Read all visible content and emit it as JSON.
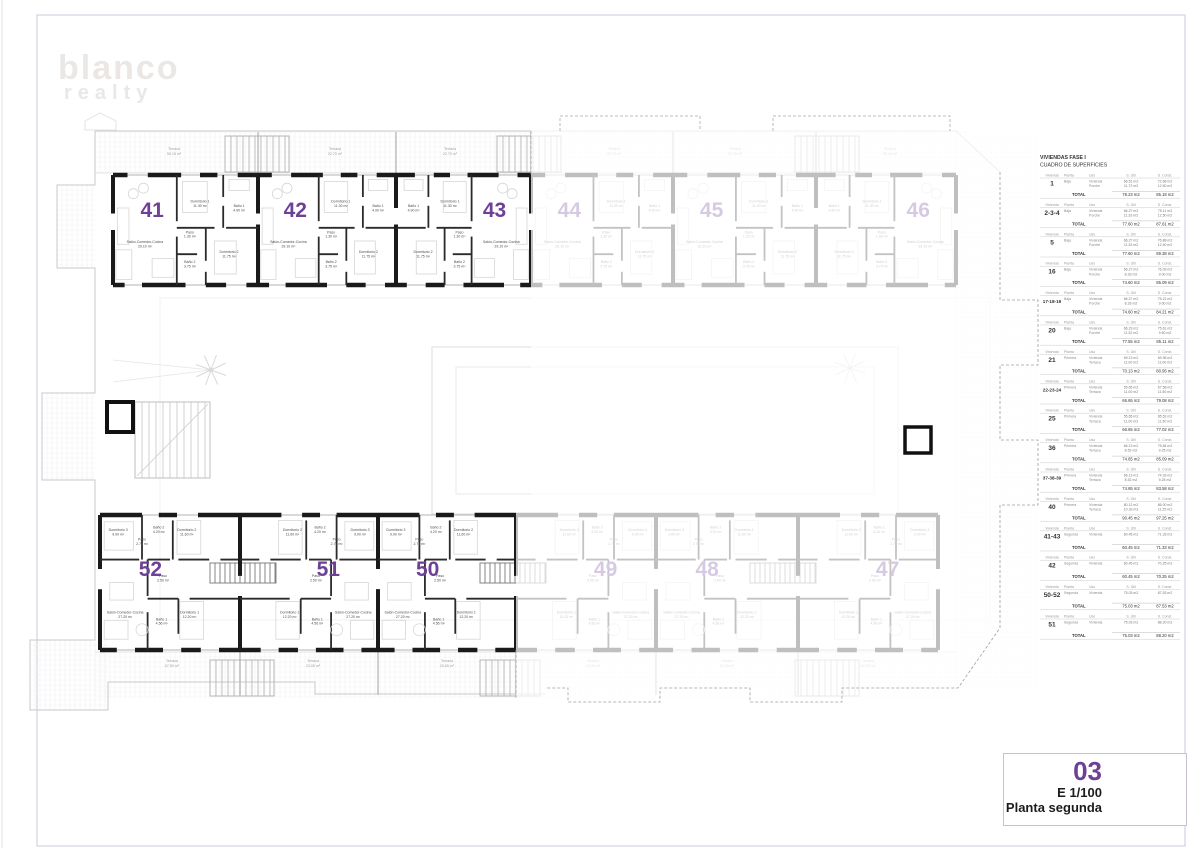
{
  "sheet": {
    "watermark_line1": "blanco",
    "watermark_line2": "realty",
    "number": "03",
    "scale": "E 1/100",
    "floor_name": "Planta segunda",
    "accent_color": "#6e4096"
  },
  "surfaces_table": {
    "title1": "VIVIENDAS FASE I",
    "title2": "CUADRO DE SUPERFICIES",
    "headers": [
      "Vivienda",
      "Planta",
      "Uso",
      "S. Útil",
      "S. Const."
    ],
    "total_label": "TOTAL",
    "blocks": [
      {
        "vivienda": "1",
        "planta": "Baja",
        "usos": [
          {
            "uso": "Vivienda",
            "util": "66.51 m2",
            "const": "72.68 m2"
          },
          {
            "uso": "Porche",
            "util": "11.72 m2",
            "const": "12.50 m2"
          }
        ],
        "total_util": "78.23 m2",
        "total_const": "85.18 m2"
      },
      {
        "vivienda": "2-3-4",
        "planta": "Baja",
        "usos": [
          {
            "uso": "Vivienda",
            "util": "66.27 m2",
            "const": "75.11 m2"
          },
          {
            "uso": "Porche",
            "util": "11.33 m2",
            "const": "12.50 m2"
          }
        ],
        "total_util": "77.60 m2",
        "total_const": "87.61 m2"
      },
      {
        "vivienda": "5",
        "planta": "Baja",
        "usos": [
          {
            "uso": "Vivienda",
            "util": "66.27 m2",
            "const": "76.88 m2"
          },
          {
            "uso": "Porche",
            "util": "11.33 m2",
            "const": "12.50 m2"
          }
        ],
        "total_util": "77.60 m2",
        "total_const": "89.38 m2"
      },
      {
        "vivienda": "16",
        "planta": "Baja",
        "usos": [
          {
            "uso": "Vivienda",
            "util": "66.27 m2",
            "const": "76.09 m2"
          },
          {
            "uso": "Porche",
            "util": "8.33 m2",
            "const": "9.00 m2"
          }
        ],
        "total_util": "74.60 m2",
        "total_const": "85.09 m2"
      },
      {
        "vivienda": "17-18-19",
        "planta": "Baja",
        "usos": [
          {
            "uso": "Vivienda",
            "util": "66.27 m2",
            "const": "75.21 m2"
          },
          {
            "uso": "Porche",
            "util": "8.33 m2",
            "const": "9.00 m2"
          }
        ],
        "total_util": "74.60 m2",
        "total_const": "84.21 m2"
      },
      {
        "vivienda": "20",
        "planta": "Baja",
        "usos": [
          {
            "uso": "Vivienda",
            "util": "66.23 m2",
            "const": "75.61 m2"
          },
          {
            "uso": "Porche",
            "util": "11.32 m2",
            "const": "9.50 m2"
          }
        ],
        "total_util": "77.55 m2",
        "total_const": "85.11 m2"
      },
      {
        "vivienda": "21",
        "planta": "Primera",
        "usos": [
          {
            "uso": "Vivienda",
            "util": "59.13 m2",
            "const": "69.95 m2"
          },
          {
            "uso": "Terraza",
            "util": "11.00 m2",
            "const": "11.00 m2"
          }
        ],
        "total_util": "70.13 m2",
        "total_const": "80.95 m2"
      },
      {
        "vivienda": "22-23-24",
        "planta": "Primera",
        "usos": [
          {
            "uso": "Vivienda",
            "util": "55.65 m2",
            "const": "67.58 m2"
          },
          {
            "uso": "Terraza",
            "util": "11.00 m2",
            "const": "11.50 m2"
          }
        ],
        "total_util": "66.65 m2",
        "total_const": "79.08 m2"
      },
      {
        "vivienda": "25",
        "planta": "Primera",
        "usos": [
          {
            "uso": "Vivienda",
            "util": "55.65 m2",
            "const": "65.52 m2"
          },
          {
            "uso": "Terraza",
            "util": "11.00 m2",
            "const": "11.50 m2"
          }
        ],
        "total_util": "66.65 m2",
        "total_const": "77.02 m2"
      },
      {
        "vivienda": "36",
        "planta": "Primera",
        "usos": [
          {
            "uso": "Vivienda",
            "util": "66.13 m2",
            "const": "75.84 m2"
          },
          {
            "uso": "Terraza",
            "util": "8.52 m2",
            "const": "9.25 m2"
          }
        ],
        "total_util": "74.65 m2",
        "total_const": "85.09 m2"
      },
      {
        "vivienda": "37-38-39",
        "planta": "Primera",
        "usos": [
          {
            "uso": "Vivienda",
            "util": "66.13 m2",
            "const": "74.33 m2"
          },
          {
            "uso": "Terraza",
            "util": "8.52 m2",
            "const": "9.25 m2"
          }
        ],
        "total_util": "74.65 m2",
        "total_const": "83.58 m2"
      },
      {
        "vivienda": "40",
        "planta": "Primera",
        "usos": [
          {
            "uso": "Vivienda",
            "util": "80.12 m2",
            "const": "86.00 m2"
          },
          {
            "uso": "Terraza",
            "util": "10.33 m2",
            "const": "11.25 m2"
          }
        ],
        "total_util": "90.45 m2",
        "total_const": "97.25 m2"
      },
      {
        "vivienda": "41-43",
        "planta": "Segunda",
        "usos": [
          {
            "uso": "Vivienda",
            "util": "60.45 m2",
            "const": "71.33 m2"
          }
        ],
        "total_util": "60.45 m2",
        "total_const": "71.33 m2"
      },
      {
        "vivienda": "42",
        "planta": "Segunda",
        "usos": [
          {
            "uso": "Vivienda",
            "util": "60.45 m2",
            "const": "70.25 m2"
          }
        ],
        "total_util": "60.45 m2",
        "total_const": "70.25 m2"
      },
      {
        "vivienda": "50-52",
        "planta": "Segunda",
        "usos": [
          {
            "uso": "Vivienda",
            "util": "75.03 m2",
            "const": "87.53 m2"
          }
        ],
        "total_util": "75.03 m2",
        "total_const": "87.53 m2"
      },
      {
        "vivienda": "51",
        "planta": "Segunda",
        "usos": [
          {
            "uso": "Vivienda",
            "util": "75.03 m2",
            "const": "88.20 m2"
          }
        ],
        "total_util": "75.03 m2",
        "total_const": "88.20 m2"
      }
    ]
  },
  "plan": {
    "terraces_top": [
      {
        "label": "Terraza",
        "area": "59.18 m²",
        "faded": false
      },
      {
        "label": "Terraza",
        "area": "22.70 m²",
        "faded": false
      },
      {
        "label": "Terraza",
        "area": "22.70 m²",
        "faded": false
      },
      {
        "label": "Terraza",
        "area": "22.70 m²",
        "faded": true
      },
      {
        "label": "Terraza",
        "area": "22.70 m²",
        "faded": true
      },
      {
        "label": "Terraza",
        "area": "59.18 m²",
        "faded": true
      }
    ],
    "terraces_bottom": [
      {
        "label": "Terraza",
        "area": "67.50 m²",
        "faded": false
      },
      {
        "label": "Terraza",
        "area": "23.05 m²",
        "faded": false
      },
      {
        "label": "Terraza",
        "area": "25.65 m²",
        "faded": false
      },
      {
        "label": "Terraza",
        "area": "23.05 m²",
        "faded": true
      },
      {
        "label": "Terraza",
        "area": "23.05 m²",
        "faded": true
      },
      {
        "label": "Terraza",
        "area": "67.50 m²",
        "faded": true
      }
    ],
    "rooms_top_type": [
      {
        "name": "Salón-Comedor-Cocina",
        "area": "29.10 m²"
      },
      {
        "name": "Dormitorio 1",
        "area": "11.30 m²"
      },
      {
        "name": "Baño 1",
        "area": "4.90 m²"
      },
      {
        "name": "Paso",
        "area": "1.30 m²"
      },
      {
        "name": "Baño 2",
        "area": "3.75 m²"
      },
      {
        "name": "Dormitorio 2",
        "area": "11.75 m²"
      }
    ],
    "rooms_bottom_type": [
      {
        "name": "Salón-Comedor-Cocina",
        "area": "27.20 m²"
      },
      {
        "name": "Dormitorio 1",
        "area": "12.20 m²"
      },
      {
        "name": "Dormitorio 2",
        "area": "11.60 m²"
      },
      {
        "name": "Dormitorio 3",
        "area": "9.00 m²"
      },
      {
        "name": "Baño 1",
        "area": "4.56 m²"
      },
      {
        "name": "Baño 2",
        "area": "4.20 m²"
      },
      {
        "name": "Paso",
        "area": "2.50 m²"
      },
      {
        "name": "Paso",
        "area": "2.70 m²"
      }
    ],
    "units": [
      {
        "number": "41",
        "row": "top",
        "faded": false
      },
      {
        "number": "42",
        "row": "top",
        "faded": false
      },
      {
        "number": "43",
        "row": "top",
        "faded": false
      },
      {
        "number": "44",
        "row": "top",
        "faded": true
      },
      {
        "number": "45",
        "row": "top",
        "faded": true
      },
      {
        "number": "46",
        "row": "top",
        "faded": true
      },
      {
        "number": "52",
        "row": "bottom",
        "faded": false
      },
      {
        "number": "51",
        "row": "bottom",
        "faded": false
      },
      {
        "number": "50",
        "row": "bottom",
        "faded": false
      },
      {
        "number": "49",
        "row": "bottom",
        "faded": true
      },
      {
        "number": "48",
        "row": "bottom",
        "faded": true
      },
      {
        "number": "47",
        "row": "bottom",
        "faded": true
      }
    ]
  }
}
